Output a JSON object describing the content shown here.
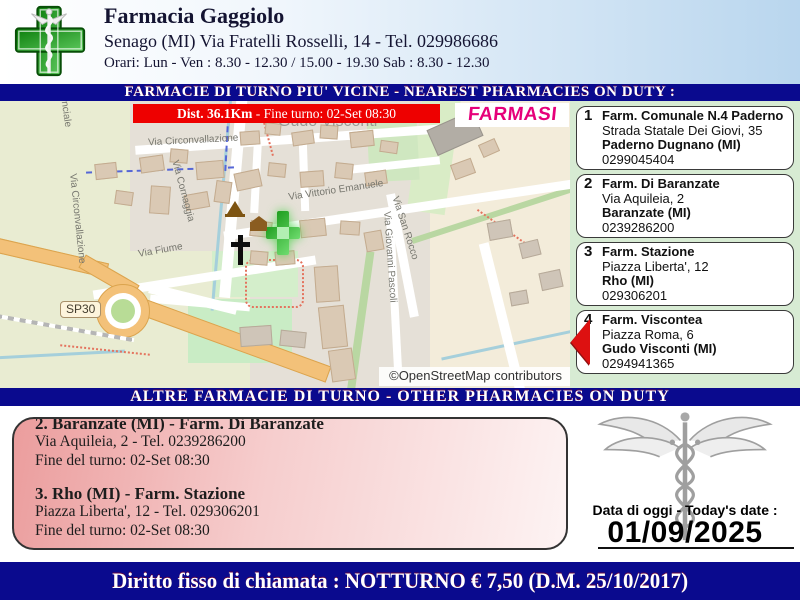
{
  "header": {
    "title": "Farmacia Gaggiolo",
    "address": "Senago (MI) Via Fratelli Rosselli, 14 - Tel. 029986686",
    "hours": "Orari: Lun - Ven : 8.30 - 12.30 / 15.00 - 19.30 Sab : 8.30 - 12.30"
  },
  "banners": {
    "nearest": "FARMACIE DI TURNO PIU' VICINE - NEAREST PHARMACIES ON DUTY :",
    "other": "ALTRE FARMACIE DI TURNO - OTHER PHARMACIES ON DUTY",
    "footer": "Diritto fisso di chiamata : NOTTURNO € 7,50 (D.M. 25/10/2017)"
  },
  "map": {
    "dist_bold": "Dist. 36.1Km",
    "dist_rest": " - Fine turno: 02-Set 08:30",
    "labels": {
      "farmasi": "FARMASI",
      "place": "Gudo Visconti",
      "provinciale": "Strada Provinciale",
      "circonvallazione": "Via Circonvallazione",
      "cornaggia": "Via Cornaggia",
      "vittorio": "Via Vittorio Emanuele",
      "sanrocco": "Via San Rocco",
      "fiume": "Via Fiume",
      "pascoli": "Via Giovanni Pascoli",
      "sp30": "SP30",
      "attribution": "©OpenStreetMap contributors"
    }
  },
  "duty_list": [
    {
      "num": "1",
      "name": "Farm. Comunale N.4 Paderno",
      "address": "Strada Statale Dei Giovi, 35",
      "city": "Paderno Dugnano (MI)",
      "phone": "0299045404"
    },
    {
      "num": "2",
      "name": "Farm. Di Baranzate",
      "address": "Via Aquileia, 2",
      "city": "Baranzate (MI)",
      "phone": "0239286200"
    },
    {
      "num": "3",
      "name": "Farm. Stazione",
      "address": "Piazza Liberta', 12",
      "city": "Rho (MI)",
      "phone": "029306201"
    },
    {
      "num": "4",
      "name": "Farm. Viscontea",
      "address": "Piazza Roma, 6",
      "city": "Gudo Visconti (MI)",
      "phone": "0294941365"
    }
  ],
  "other_list": [
    {
      "title": "2. Baranzate (MI) - Farm. Di Baranzate",
      "address": "Via Aquileia, 2 - Tel. 0239286200",
      "shift": "Fine del turno: 02-Set 08:30"
    },
    {
      "title": "3. Rho (MI) - Farm. Stazione",
      "address": "Piazza Liberta', 12 - Tel. 029306201",
      "shift": "Fine del turno: 02-Set 08:30"
    }
  ],
  "date_box": {
    "label": "Data di oggi - Today's date :",
    "date": "01/09/2025"
  },
  "colors": {
    "banner_navy": "#0a0a8e",
    "alert_red": "#ee0000",
    "farmasi_magenta": "#e6007a",
    "pharmacy_green": "#2e8b2e",
    "sidebar_green": "#d7ebd3",
    "otherbox_pink": "#eb9d9d"
  }
}
